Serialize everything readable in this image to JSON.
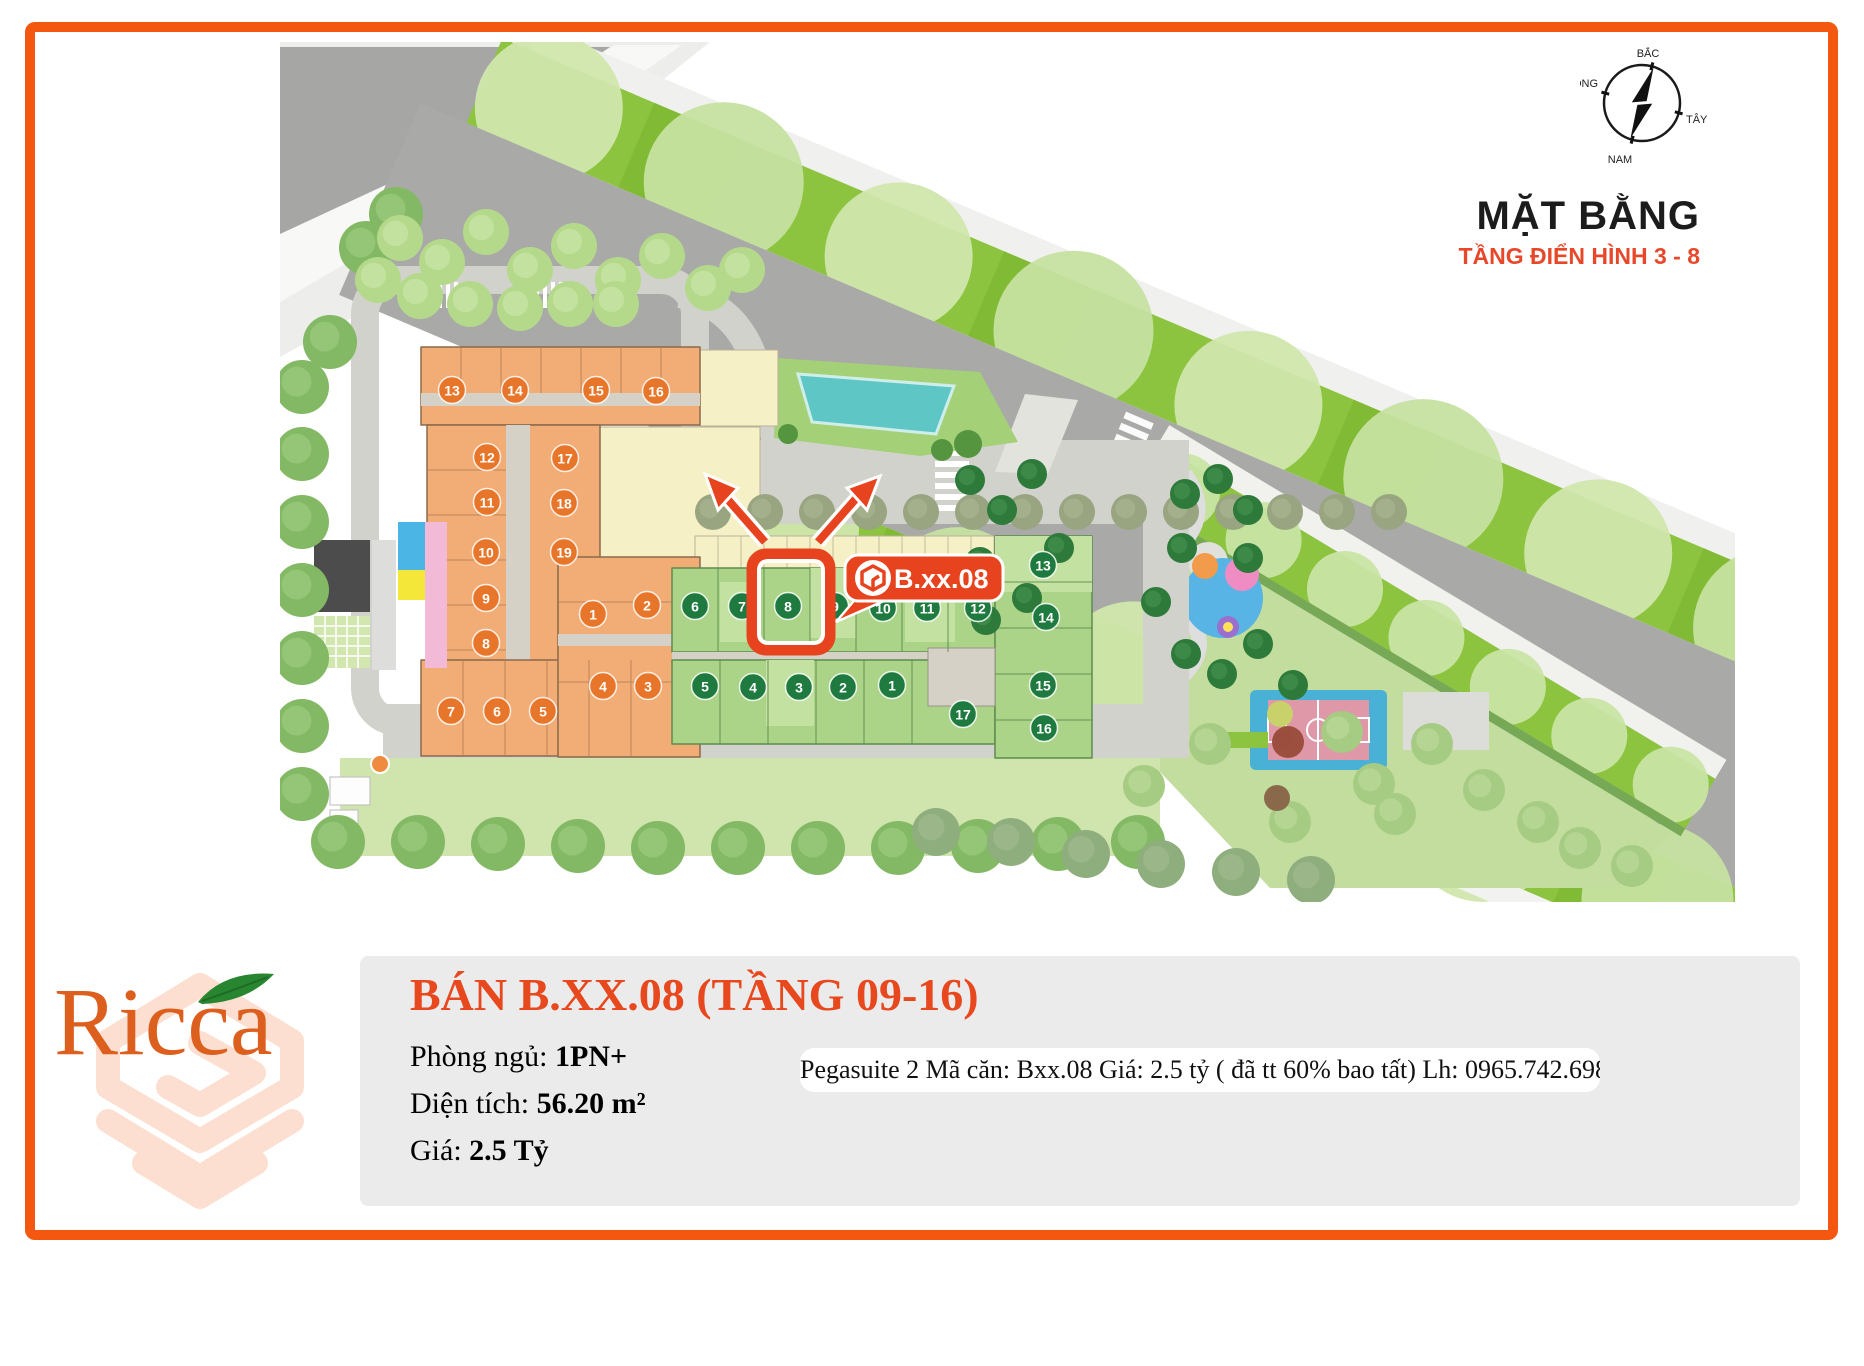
{
  "page": {
    "frame_color": "#f4570f",
    "background": "#ffffff"
  },
  "map": {
    "title": "MẶT BẰNG",
    "subtitle": "TẦNG ĐIỂN HÌNH 3 - 8",
    "callout_label": "B.xx.08",
    "compass": {
      "north": "BẮC",
      "east": "ĐÔNG",
      "west": "TÂY",
      "south": "NAM"
    },
    "building_a_units": [
      "1",
      "2",
      "3",
      "4",
      "5",
      "6",
      "7",
      "8",
      "9",
      "10",
      "11",
      "12",
      "13",
      "14",
      "15",
      "16",
      "17",
      "18",
      "19"
    ],
    "building_b_units": [
      "1",
      "2",
      "3",
      "4",
      "5",
      "6",
      "7",
      "8",
      "9",
      "10",
      "11",
      "12",
      "13",
      "14",
      "15",
      "16",
      "17"
    ],
    "highlighted_unit": "8"
  },
  "logo": {
    "text": "Ricca"
  },
  "listing": {
    "title": "BÁN B.XX.08 (TẦNG 09-16)",
    "bedrooms_label": "Phòng ngủ:",
    "bedrooms_value": "1PN+",
    "area_label": "Diện tích:",
    "area_value": "56.20 m²",
    "price_label": "Giá:",
    "price_value": "2.5 Tỷ",
    "note": "Pegasuite 2 Mã căn: Bxx.08 Giá: 2.5 tỷ ( đã tt 60% bao tất) Lh: 0965.742.698"
  },
  "colors": {
    "accent": "#e8481d",
    "highlight": "#e8431f",
    "building_a_fill": "#f2ad77",
    "building_b_fill": "#abd489",
    "marker_a": "#e8762a",
    "marker_b": "#1f7a3f",
    "median_green": "#8cc43f",
    "road_gray": "#a9a9a7"
  }
}
